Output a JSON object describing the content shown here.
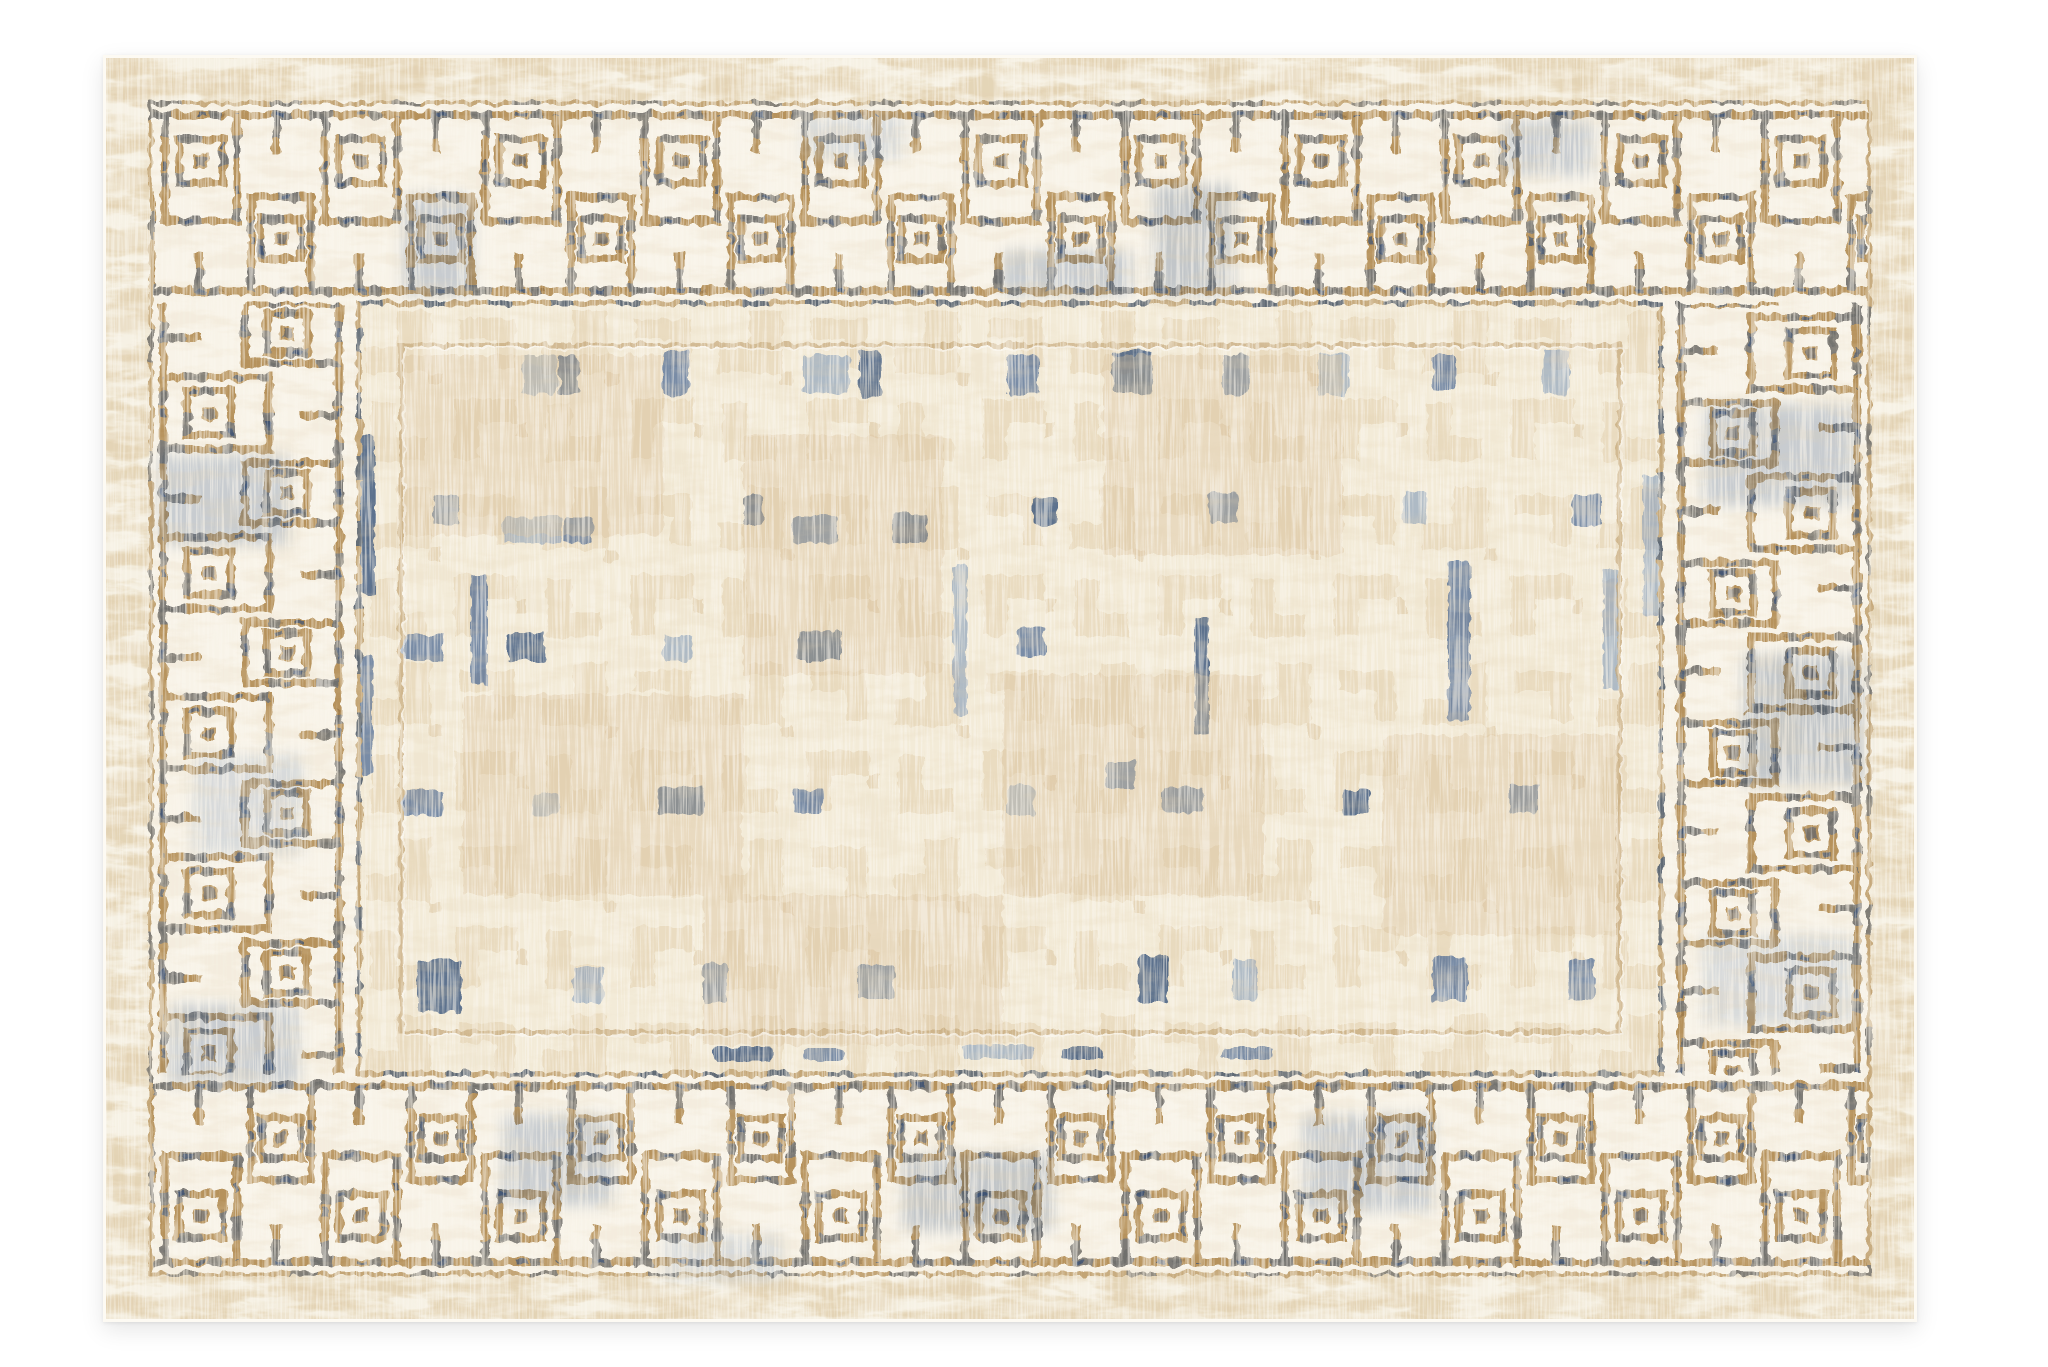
{
  "scene": {
    "type": "product-photograph",
    "subject": "rectangular area rug, viewed flat from above on a white backdrop",
    "style": "vintage distressed Greek-key labyrinth border rug",
    "aria_label": "Cream and beige rectangular area rug with an embossed Greek key labyrinth border accented in tan and washed navy blue, around a distressed beige tile-grid field"
  },
  "palette": {
    "background": "#ffffff",
    "rug_base": "#f6f1e4",
    "outer_band_beige": "#e3d2b2",
    "maze_ground": "#f8f3e8",
    "groove_tan": "#b6925c",
    "groove_dark_tan": "#8f6e3e",
    "accent_blue": "#41618f",
    "accent_navy": "#2c4a74",
    "accent_steel": "#7e97b8",
    "field_base": "#f3ebd8",
    "field_block_beige": "#e4d0ad",
    "field_block_deep": "#d9c19a",
    "frame_line": "#c3a576",
    "selvedge": "#fdfaf3"
  },
  "field_accents": [
    {
      "x": 258,
      "y": 380,
      "w": 14,
      "h": 160,
      "c": "navy"
    },
    {
      "x": 258,
      "y": 600,
      "w": 12,
      "h": 120,
      "c": "blue"
    },
    {
      "x": 420,
      "y": 300,
      "w": 34,
      "h": 40,
      "c": "steel"
    },
    {
      "x": 456,
      "y": 300,
      "w": 20,
      "h": 40,
      "c": "navy"
    },
    {
      "x": 560,
      "y": 296,
      "w": 26,
      "h": 44,
      "c": "blue"
    },
    {
      "x": 700,
      "y": 300,
      "w": 46,
      "h": 38,
      "c": "steel"
    },
    {
      "x": 756,
      "y": 296,
      "w": 22,
      "h": 46,
      "c": "navy"
    },
    {
      "x": 905,
      "y": 300,
      "w": 30,
      "h": 40,
      "c": "blue"
    },
    {
      "x": 1010,
      "y": 296,
      "w": 40,
      "h": 42,
      "c": "navy"
    },
    {
      "x": 1120,
      "y": 300,
      "w": 26,
      "h": 40,
      "c": "blue"
    },
    {
      "x": 1215,
      "y": 298,
      "w": 30,
      "h": 42,
      "c": "steel"
    },
    {
      "x": 1330,
      "y": 300,
      "w": 22,
      "h": 36,
      "c": "blue"
    },
    {
      "x": 1440,
      "y": 296,
      "w": 26,
      "h": 44,
      "c": "steel"
    },
    {
      "x": 330,
      "y": 440,
      "w": 26,
      "h": 30,
      "c": "blue"
    },
    {
      "x": 400,
      "y": 462,
      "w": 60,
      "h": 26,
      "c": "steel"
    },
    {
      "x": 462,
      "y": 462,
      "w": 28,
      "h": 26,
      "c": "blue"
    },
    {
      "x": 640,
      "y": 440,
      "w": 20,
      "h": 30,
      "c": "navy"
    },
    {
      "x": 690,
      "y": 460,
      "w": 44,
      "h": 28,
      "c": "blue"
    },
    {
      "x": 790,
      "y": 458,
      "w": 34,
      "h": 30,
      "c": "navy"
    },
    {
      "x": 930,
      "y": 442,
      "w": 24,
      "h": 28,
      "c": "navy"
    },
    {
      "x": 1105,
      "y": 438,
      "w": 30,
      "h": 30,
      "c": "blue"
    },
    {
      "x": 1300,
      "y": 436,
      "w": 24,
      "h": 34,
      "c": "steel"
    },
    {
      "x": 1470,
      "y": 440,
      "w": 28,
      "h": 30,
      "c": "blue"
    },
    {
      "x": 1540,
      "y": 420,
      "w": 16,
      "h": 140,
      "c": "steel"
    },
    {
      "x": 368,
      "y": 520,
      "w": 16,
      "h": 110,
      "c": "blue"
    },
    {
      "x": 850,
      "y": 510,
      "w": 14,
      "h": 150,
      "c": "steel"
    },
    {
      "x": 1092,
      "y": 560,
      "w": 14,
      "h": 120,
      "c": "navy"
    },
    {
      "x": 1345,
      "y": 505,
      "w": 22,
      "h": 160,
      "c": "blue"
    },
    {
      "x": 1500,
      "y": 515,
      "w": 16,
      "h": 120,
      "c": "steel"
    },
    {
      "x": 300,
      "y": 580,
      "w": 40,
      "h": 26,
      "c": "blue"
    },
    {
      "x": 404,
      "y": 578,
      "w": 38,
      "h": 28,
      "c": "navy"
    },
    {
      "x": 560,
      "y": 580,
      "w": 30,
      "h": 26,
      "c": "steel"
    },
    {
      "x": 695,
      "y": 576,
      "w": 44,
      "h": 30,
      "c": "navy"
    },
    {
      "x": 914,
      "y": 572,
      "w": 28,
      "h": 30,
      "c": "blue"
    },
    {
      "x": 1002,
      "y": 706,
      "w": 30,
      "h": 28,
      "c": "blue"
    },
    {
      "x": 300,
      "y": 735,
      "w": 40,
      "h": 26,
      "c": "blue"
    },
    {
      "x": 430,
      "y": 738,
      "w": 26,
      "h": 22,
      "c": "steel"
    },
    {
      "x": 555,
      "y": 732,
      "w": 46,
      "h": 28,
      "c": "navy"
    },
    {
      "x": 690,
      "y": 735,
      "w": 30,
      "h": 24,
      "c": "blue"
    },
    {
      "x": 905,
      "y": 730,
      "w": 26,
      "h": 30,
      "c": "steel"
    },
    {
      "x": 1060,
      "y": 732,
      "w": 40,
      "h": 26,
      "c": "blue"
    },
    {
      "x": 1240,
      "y": 735,
      "w": 26,
      "h": 24,
      "c": "navy"
    },
    {
      "x": 1405,
      "y": 730,
      "w": 30,
      "h": 28,
      "c": "blue"
    },
    {
      "x": 315,
      "y": 905,
      "w": 44,
      "h": 52,
      "c": "navy"
    },
    {
      "x": 470,
      "y": 912,
      "w": 30,
      "h": 36,
      "c": "steel"
    },
    {
      "x": 600,
      "y": 908,
      "w": 24,
      "h": 40,
      "c": "blue"
    },
    {
      "x": 755,
      "y": 910,
      "w": 36,
      "h": 34,
      "c": "blue"
    },
    {
      "x": 1035,
      "y": 900,
      "w": 30,
      "h": 48,
      "c": "navy"
    },
    {
      "x": 1130,
      "y": 905,
      "w": 24,
      "h": 40,
      "c": "steel"
    },
    {
      "x": 1330,
      "y": 902,
      "w": 34,
      "h": 44,
      "c": "blue"
    },
    {
      "x": 1465,
      "y": 905,
      "w": 26,
      "h": 40,
      "c": "blue"
    },
    {
      "x": 610,
      "y": 992,
      "w": 60,
      "h": 14,
      "c": "navy"
    },
    {
      "x": 700,
      "y": 994,
      "w": 40,
      "h": 12,
      "c": "blue"
    },
    {
      "x": 860,
      "y": 990,
      "w": 70,
      "h": 14,
      "c": "steel"
    },
    {
      "x": 960,
      "y": 992,
      "w": 40,
      "h": 12,
      "c": "navy"
    },
    {
      "x": 1120,
      "y": 992,
      "w": 50,
      "h": 12,
      "c": "blue"
    },
    {
      "x": 300,
      "y": 300,
      "w": 260,
      "h": 180,
      "c": "beige"
    },
    {
      "x": 640,
      "y": 380,
      "w": 200,
      "h": 240,
      "c": "beige"
    },
    {
      "x": 1000,
      "y": 300,
      "w": 240,
      "h": 200,
      "c": "beige"
    },
    {
      "x": 360,
      "y": 640,
      "w": 280,
      "h": 200,
      "c": "beige"
    },
    {
      "x": 900,
      "y": 620,
      "w": 260,
      "h": 220,
      "c": "beige"
    },
    {
      "x": 1280,
      "y": 680,
      "w": 240,
      "h": 200,
      "c": "beige"
    },
    {
      "x": 600,
      "y": 840,
      "w": 300,
      "h": 150,
      "c": "beige"
    }
  ],
  "border_accents": [
    {
      "x": 300,
      "y": 140,
      "w": 70,
      "h": 100,
      "c": "blue"
    },
    {
      "x": 700,
      "y": 60,
      "w": 100,
      "h": 44,
      "c": "steel"
    },
    {
      "x": 1050,
      "y": 130,
      "w": 80,
      "h": 110,
      "c": "navy"
    },
    {
      "x": 1400,
      "y": 66,
      "w": 90,
      "h": 54,
      "c": "blue"
    },
    {
      "x": 900,
      "y": 196,
      "w": 130,
      "h": 44,
      "c": "blue"
    },
    {
      "x": 56,
      "y": 400,
      "w": 130,
      "h": 90,
      "c": "blue"
    },
    {
      "x": 90,
      "y": 700,
      "w": 110,
      "h": 100,
      "c": "steel"
    },
    {
      "x": 66,
      "y": 950,
      "w": 130,
      "h": 80,
      "c": "blue"
    },
    {
      "x": 1600,
      "y": 350,
      "w": 150,
      "h": 100,
      "c": "blue"
    },
    {
      "x": 1640,
      "y": 600,
      "w": 120,
      "h": 130,
      "c": "navy"
    },
    {
      "x": 1600,
      "y": 880,
      "w": 150,
      "h": 90,
      "c": "steel"
    },
    {
      "x": 400,
      "y": 1060,
      "w": 110,
      "h": 90,
      "c": "blue"
    },
    {
      "x": 800,
      "y": 1100,
      "w": 150,
      "h": 76,
      "c": "navy"
    },
    {
      "x": 1200,
      "y": 1060,
      "w": 130,
      "h": 96,
      "c": "blue"
    },
    {
      "x": 560,
      "y": 1180,
      "w": 120,
      "h": 46,
      "c": "steel"
    }
  ]
}
